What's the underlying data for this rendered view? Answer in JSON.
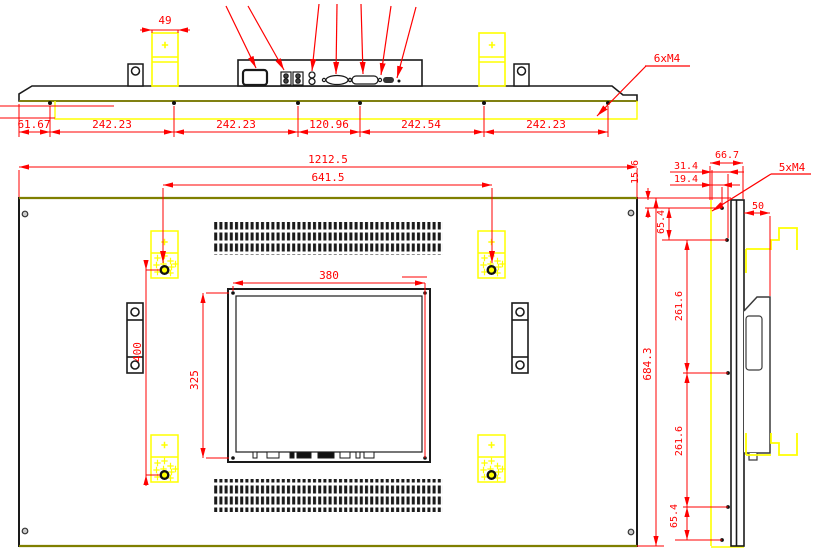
{
  "colors": {
    "dimension_red": "#ff0000",
    "highlight_yellow": "#ffff00",
    "geometry_black": "#1a1a1a",
    "edge_olive": "#7f7f00"
  },
  "top_view": {
    "bracket_width": "49",
    "thread_callout": "6xM4",
    "spacings": [
      "61.67",
      "242.23",
      "242.23",
      "120.96",
      "242.54",
      "242.23"
    ]
  },
  "front_view": {
    "overall_width": "1212.5",
    "mount_hole_span": "641.5",
    "lcd_width": "380",
    "lcd_height": "325",
    "mount_hole_vertical": "400",
    "overall_height": "684.3"
  },
  "side_view": {
    "top_edge_offset": "15.6",
    "hole_offset_a": "31.4",
    "depth": "66.7",
    "hole_offset_b": "19.4",
    "thread_callout": "5xM4",
    "hole_spacing_top": "65.4",
    "rear_box_depth": "50",
    "hole_spacing_upper": "261.6",
    "hole_spacing_lower": "261.6",
    "hole_spacing_bottom": "65.4"
  }
}
